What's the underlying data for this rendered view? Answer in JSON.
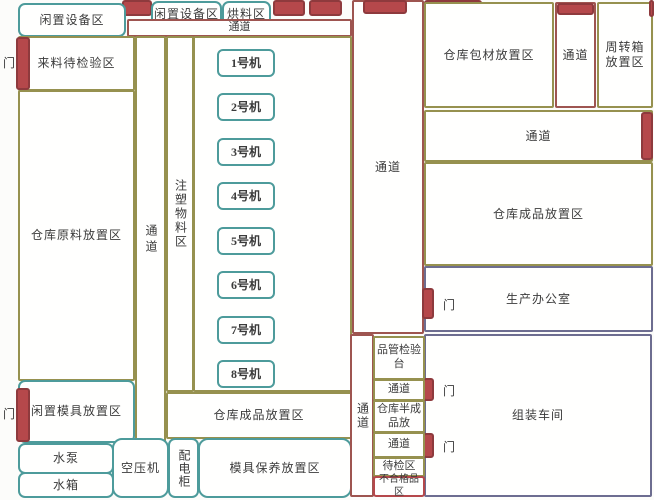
{
  "diagram": {
    "type": "factory-floor-plan",
    "language": "zh-CN"
  },
  "areas": {
    "idle_equipment": "闲置设备区",
    "drying": "烘料区",
    "aisle": "通道",
    "door": "门",
    "incoming_inspection": "来料待检验区",
    "raw_material": "仓库原料放置区",
    "injection_material": "注塑物料区",
    "idle_mold": "闲置模具放置区",
    "water_pump": "水泵",
    "water_tank": "水箱",
    "air_compressor": "空压机",
    "power_cabinet": "配电柜",
    "mold_maintenance": "模具保养放置区",
    "finished_goods": "仓库成品放置区",
    "packaging_material": "仓库包材放置区",
    "turnover_box": "周转箱放置区",
    "production_office": "生产办公室",
    "assembly_workshop": "组装车间",
    "qc_inspection": "品管检验台",
    "semi_finished": "仓库半成品放",
    "pending_inspection": "待检区",
    "nonconforming": "不合格品区"
  },
  "machines": [
    "1号机",
    "2号机",
    "3号机",
    "4号机",
    "5号机",
    "6号机",
    "7号机",
    "8号机"
  ],
  "colors": {
    "door_block_fill": "#b5484b",
    "door_block_border": "#8e3a3d",
    "teal_border": "#4d9b9b",
    "olive_border": "#96914f",
    "maroon_border": "#9e5550",
    "navy_border": "#6d6d90",
    "text": "#3b3b3b",
    "background": "#fcfcfa"
  }
}
